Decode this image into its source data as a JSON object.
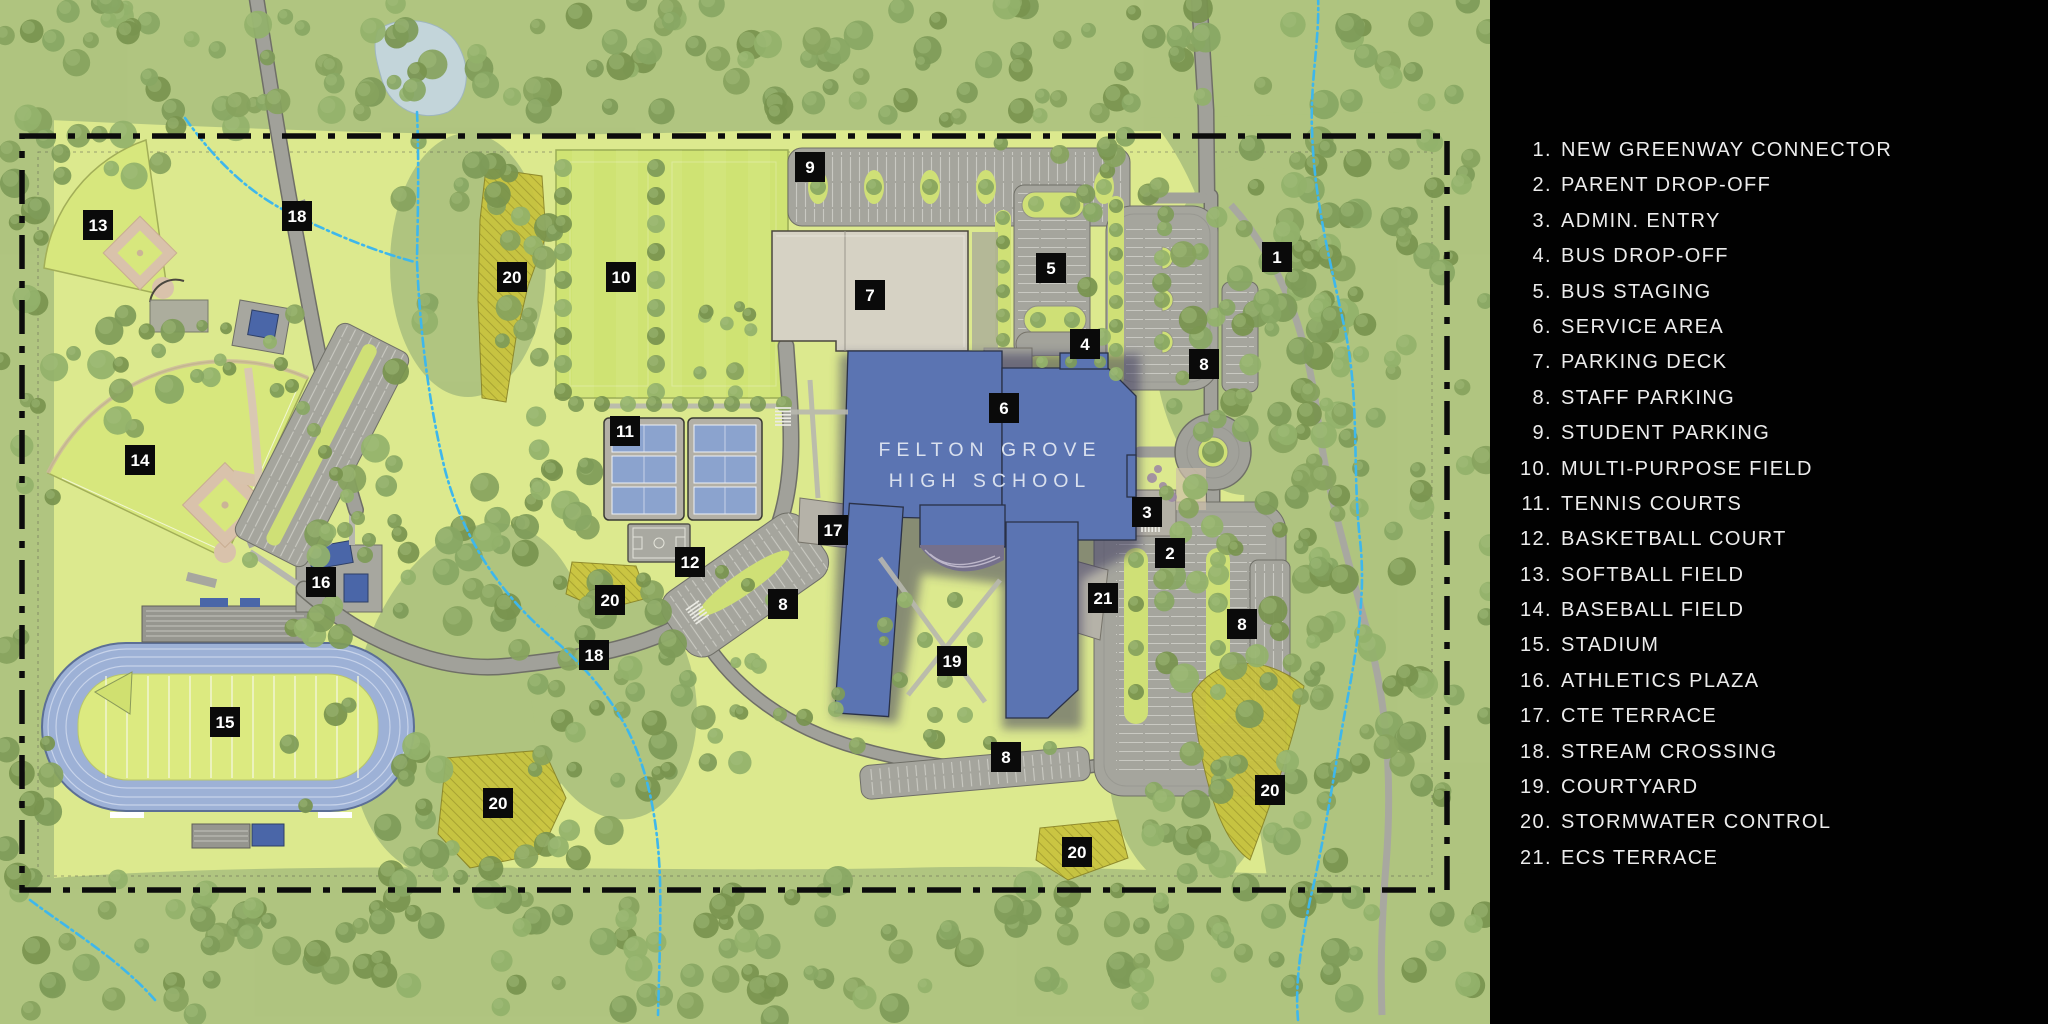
{
  "map": {
    "building_name_line1": "FELTON GROVE",
    "building_name_line2": "HIGH SCHOOL",
    "markers": [
      {
        "n": "9",
        "x": 810,
        "y": 167
      },
      {
        "n": "1",
        "x": 1277,
        "y": 257
      },
      {
        "n": "13",
        "x": 98,
        "y": 225
      },
      {
        "n": "18",
        "x": 297,
        "y": 216
      },
      {
        "n": "20",
        "x": 512,
        "y": 277
      },
      {
        "n": "10",
        "x": 621,
        "y": 277
      },
      {
        "n": "7",
        "x": 870,
        "y": 295
      },
      {
        "n": "5",
        "x": 1051,
        "y": 268
      },
      {
        "n": "4",
        "x": 1085,
        "y": 344
      },
      {
        "n": "8",
        "x": 1204,
        "y": 364
      },
      {
        "n": "6",
        "x": 1004,
        "y": 408
      },
      {
        "n": "11",
        "x": 625,
        "y": 431
      },
      {
        "n": "14",
        "x": 140,
        "y": 460
      },
      {
        "n": "3",
        "x": 1147,
        "y": 512
      },
      {
        "n": "12",
        "x": 690,
        "y": 562
      },
      {
        "n": "17",
        "x": 833,
        "y": 530
      },
      {
        "n": "2",
        "x": 1170,
        "y": 553
      },
      {
        "n": "16",
        "x": 321,
        "y": 582
      },
      {
        "n": "20",
        "x": 610,
        "y": 600
      },
      {
        "n": "8",
        "x": 783,
        "y": 604
      },
      {
        "n": "21",
        "x": 1103,
        "y": 598
      },
      {
        "n": "8",
        "x": 1242,
        "y": 624
      },
      {
        "n": "18",
        "x": 594,
        "y": 655
      },
      {
        "n": "19",
        "x": 952,
        "y": 661
      },
      {
        "n": "15",
        "x": 225,
        "y": 722
      },
      {
        "n": "8",
        "x": 1006,
        "y": 757
      },
      {
        "n": "20",
        "x": 498,
        "y": 803
      },
      {
        "n": "20",
        "x": 1270,
        "y": 790
      },
      {
        "n": "20",
        "x": 1077,
        "y": 852
      }
    ],
    "colors": {
      "building": "#5b74b2",
      "track": "#9db1d6",
      "road": "#a1a19a",
      "deck": "#d6d2c4",
      "stormwater": "#c9c33c",
      "stream": "#3eb7ec",
      "grass": "#dce98e",
      "marker_bg": "#0a0a0a",
      "legend_bg": "#010101"
    }
  },
  "legend": {
    "items": [
      {
        "num": "1.",
        "label": "NEW GREENWAY CONNECTOR"
      },
      {
        "num": "2.",
        "label": "PARENT DROP-OFF"
      },
      {
        "num": "3.",
        "label": "ADMIN. ENTRY"
      },
      {
        "num": "4.",
        "label": "BUS DROP-OFF"
      },
      {
        "num": "5.",
        "label": "BUS STAGING"
      },
      {
        "num": "6.",
        "label": "SERVICE AREA"
      },
      {
        "num": "7.",
        "label": "PARKING DECK"
      },
      {
        "num": "8.",
        "label": "STAFF PARKING"
      },
      {
        "num": "9.",
        "label": "STUDENT PARKING"
      },
      {
        "num": "10.",
        "label": "MULTI-PURPOSE FIELD"
      },
      {
        "num": "11.",
        "label": "TENNIS COURTS"
      },
      {
        "num": "12.",
        "label": "BASKETBALL COURT"
      },
      {
        "num": "13.",
        "label": "SOFTBALL FIELD"
      },
      {
        "num": "14.",
        "label": "BASEBALL FIELD"
      },
      {
        "num": "15.",
        "label": "STADIUM"
      },
      {
        "num": "16.",
        "label": "ATHLETICS PLAZA"
      },
      {
        "num": "17.",
        "label": "CTE TERRACE"
      },
      {
        "num": "18.",
        "label": "STREAM CROSSING"
      },
      {
        "num": "19.",
        "label": "COURTYARD"
      },
      {
        "num": "20.",
        "label": "STORMWATER CONTROL"
      },
      {
        "num": "21.",
        "label": "ECS TERRACE"
      }
    ]
  }
}
